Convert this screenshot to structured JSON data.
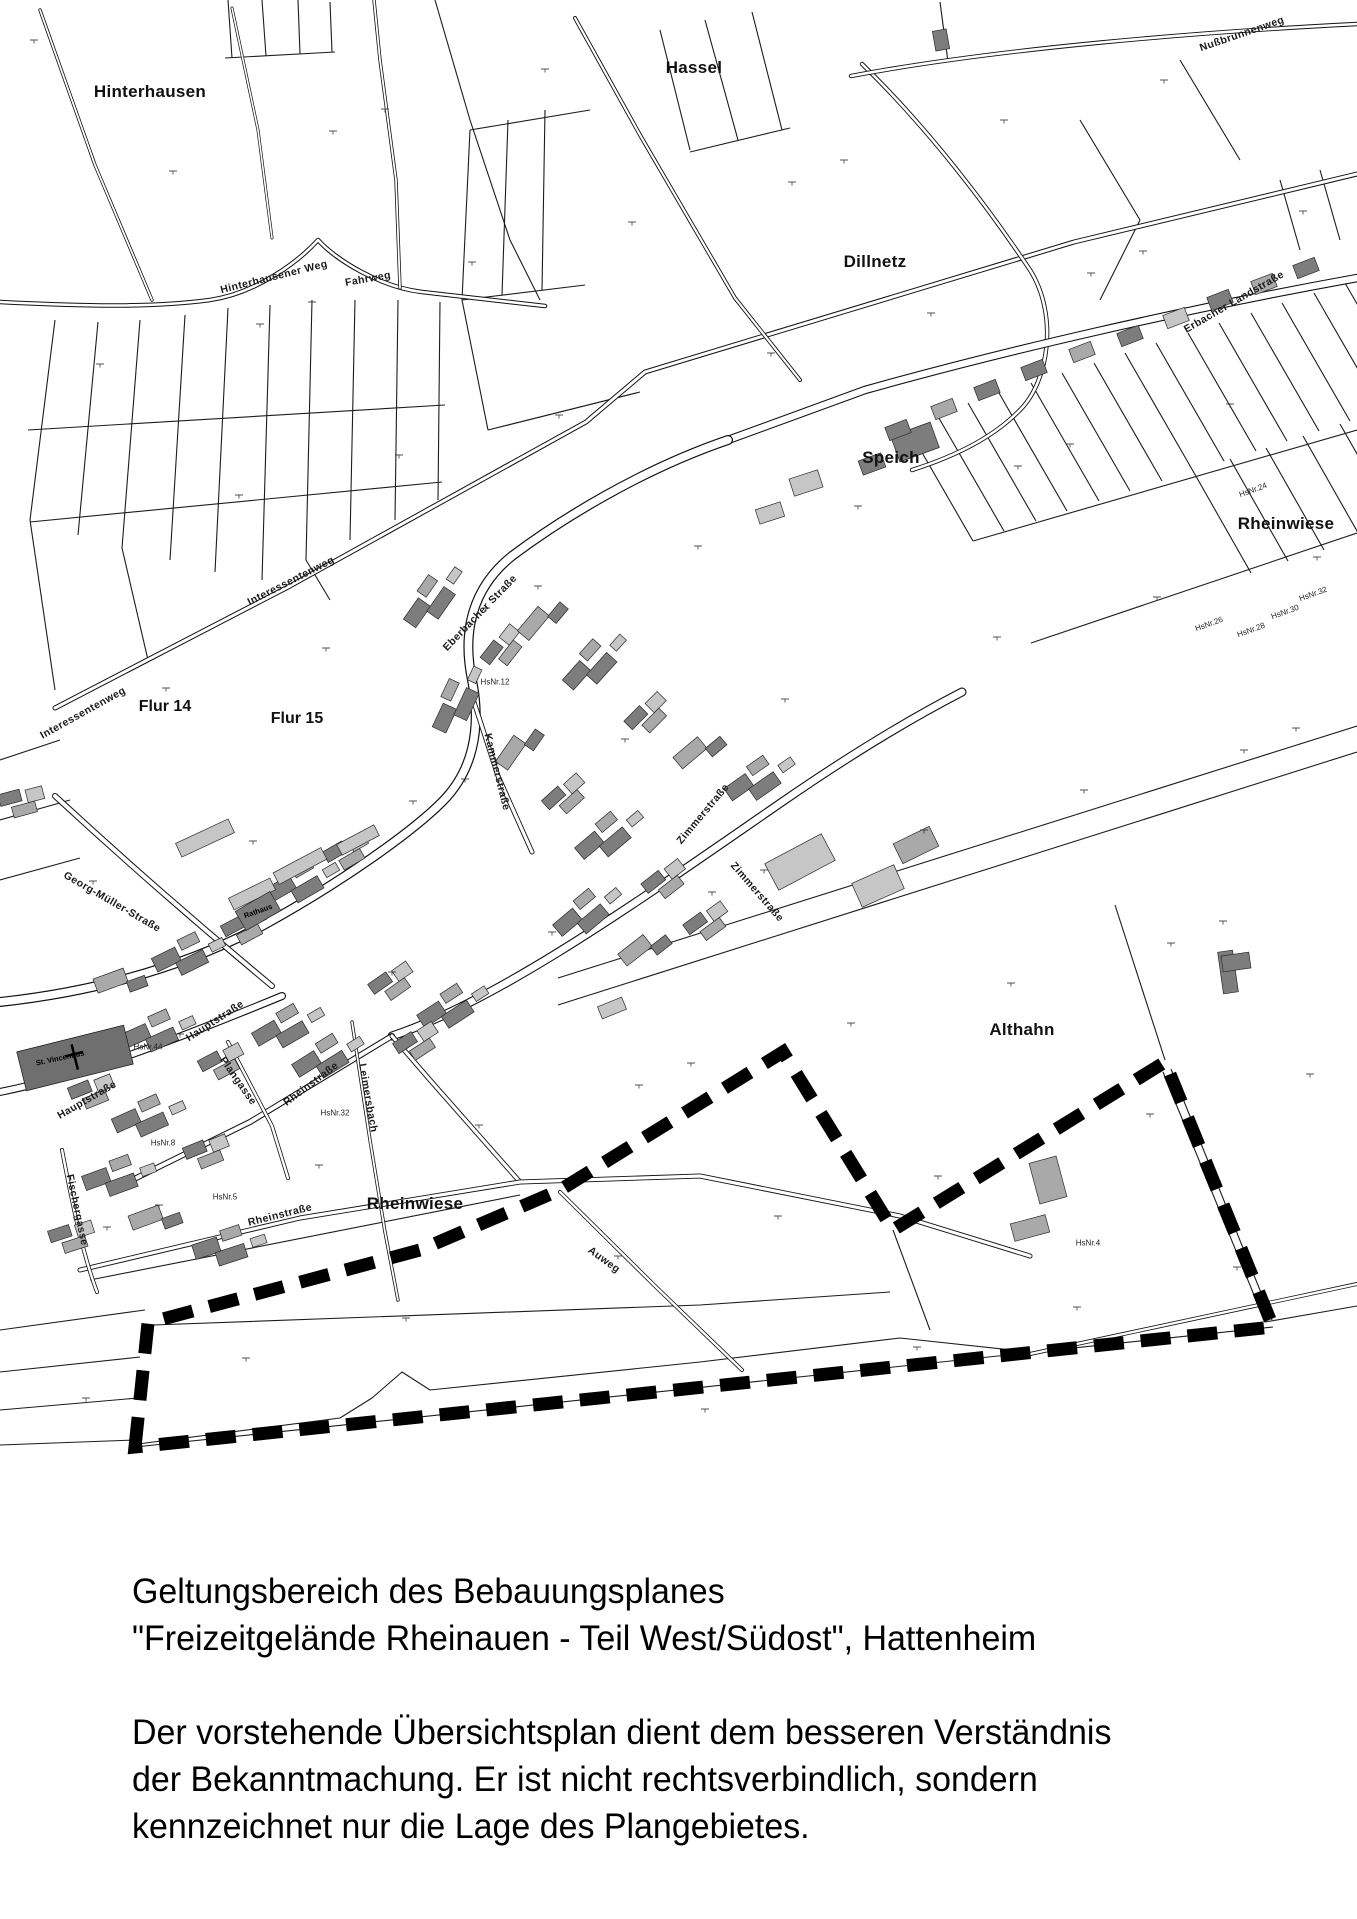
{
  "document": {
    "type": "Übersichtsplan (Bekanntmachung Bebauungsplan)",
    "municipality": "Hattenheim"
  },
  "map": {
    "boundary": {
      "name": "Geltungsbereich des Bebauungsplanes",
      "points": "135,1447 148,1323 420,1250 560,1190 783,1052 893,1230 1165,1062 1273,1327",
      "color": "#000000",
      "style": "thick black dashed line"
    },
    "labels": {
      "hinterhausen": "Hinterhausen",
      "hassel": "Hassel",
      "dillnetz": "Dillnetz",
      "speich": "Speich",
      "rheinwiese_ne": "Rheinwiese",
      "althahn": "Althahn",
      "rheinwiese_s": "Rheinwiese",
      "flur14": "Flur 14",
      "flur15": "Flur 15",
      "hinterhausener_weg": "Hinterhausener Weg",
      "fahrweg": "Fahrweg",
      "interessentenweg_1": "Interessentenweg",
      "interessentenweg_2": "Interessentenweg",
      "nussbrunnenweg": "Nußbrunnenweg",
      "erbacher_landstrasse": "Erbacher Landstraße",
      "eberbacher_strasse": "Eberbacher Straße",
      "kammerstrasse": "Kammerstraße",
      "zimmerstrasse_1": "Zimmerstraße",
      "zimmerstrasse_2": "Zimmerstraße",
      "georg_mueller_strasse": "Georg-Müller-Straße",
      "hauptstrasse_1": "Hauptstraße",
      "hauptstrasse_2": "Hauptstraße",
      "rheinstrasse_1": "Rheinstraße",
      "rheinstrasse_2": "Rheinstraße",
      "fischergasse": "Fischergasse",
      "plangasse": "Plangasse",
      "leimersbach": "Leimersbach",
      "auweg": "Auweg",
      "rathaus": "Rathaus",
      "st_vincentius": "St. Vincentius",
      "hsnr12": "HsNr.12",
      "hsnr44": "HsNr.44",
      "hsnr8": "HsNr.8",
      "hsnr5": "HsNr.5",
      "hsnr32b": "HsNr.32",
      "hsnr24": "HsNr.24",
      "hsnr26": "HsNr.26",
      "hsnr28": "HsNr.28",
      "hsnr30": "HsNr.30",
      "hsnr32": "HsNr.32",
      "hsnr4": "HsNr.4"
    },
    "colors": {
      "building_dark": "#7d7d7d",
      "building_mid": "#a9a9a9",
      "building_light": "#c6c6c6",
      "line": "#1c1c1c",
      "background": "#ffffff"
    }
  },
  "caption": {
    "title_line1": "Geltungsbereich des Bebauungsplanes",
    "title_line2": "\"Freizeitgelände Rheinauen - Teil West/Südost\", Hattenheim",
    "body_line1": "Der vorstehende Übersichtsplan dient dem besseren Verständnis",
    "body_line2": "der Bekanntmachung. Er ist nicht rechtsverbindlich, sondern",
    "body_line3": "kennzeichnet nur die Lage des Plangebietes."
  }
}
